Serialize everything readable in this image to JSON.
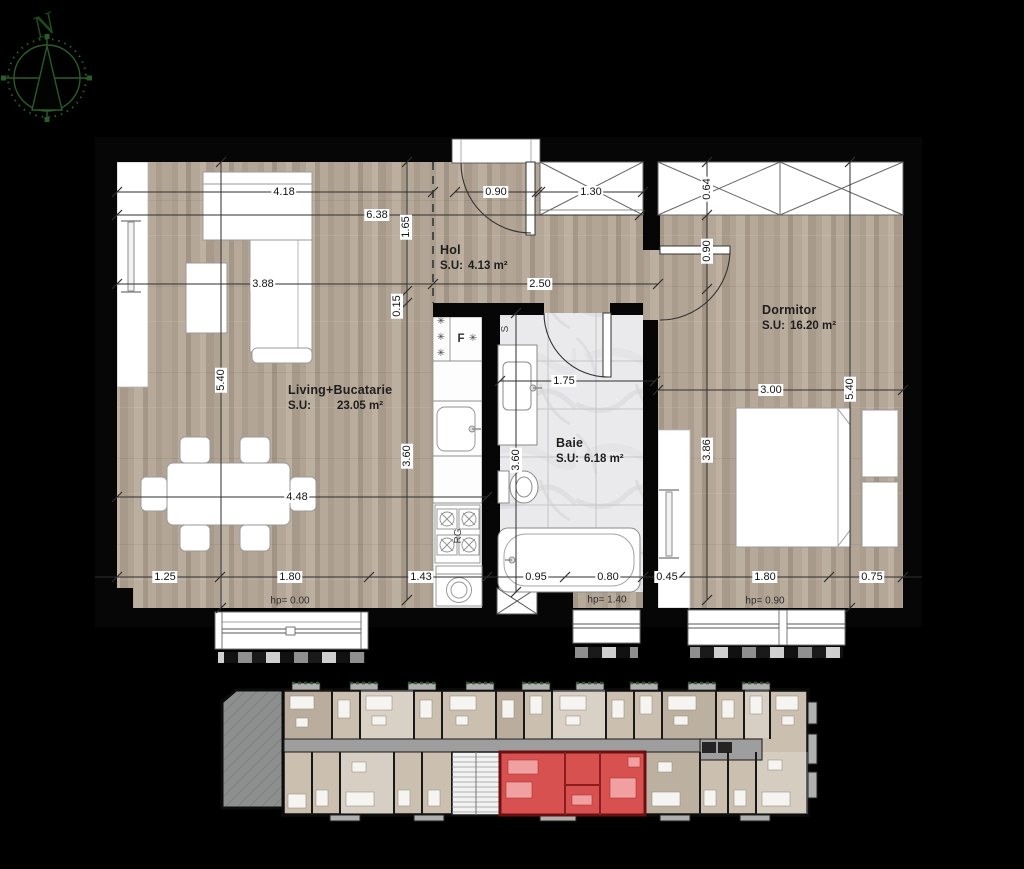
{
  "compass": {
    "north_label": "N"
  },
  "plan": {
    "rooms": [
      {
        "name": "Living+Bucatarie",
        "su": "S.U:",
        "area": "23.05 m²"
      },
      {
        "name": "Hol",
        "su": "S.U:",
        "area": "4.13 m²"
      },
      {
        "name": "Baie",
        "su": "S.U:",
        "area": "6.18 m²"
      },
      {
        "name": "Dormitor",
        "su": "S.U:",
        "area": "16.20 m²"
      }
    ],
    "dimensions": [
      {
        "t": "4.18",
        "x": 284,
        "y": 192
      },
      {
        "t": "0.90",
        "x": 496,
        "y": 192
      },
      {
        "t": "1.30",
        "x": 591,
        "y": 192
      },
      {
        "t": "6.38",
        "x": 377,
        "y": 215
      },
      {
        "t": "1.65",
        "x": 406,
        "y": 227,
        "r": 90
      },
      {
        "t": "0.64",
        "x": 707,
        "y": 189,
        "r": 90
      },
      {
        "t": "3.88",
        "x": 263,
        "y": 284
      },
      {
        "t": "2.50",
        "x": 540,
        "y": 284
      },
      {
        "t": "0.90",
        "x": 707,
        "y": 251,
        "r": 90
      },
      {
        "t": "0.15",
        "x": 397,
        "y": 306,
        "r": 90
      },
      {
        "t": "5.40",
        "x": 221,
        "y": 380,
        "r": 90
      },
      {
        "t": "1.75",
        "x": 564,
        "y": 381
      },
      {
        "t": "3.00",
        "x": 771,
        "y": 390
      },
      {
        "t": "5.40",
        "x": 850,
        "y": 389,
        "r": 90
      },
      {
        "t": "3.60",
        "x": 407,
        "y": 456,
        "r": 90
      },
      {
        "t": "3.60",
        "x": 516,
        "y": 460,
        "r": 90
      },
      {
        "t": "3.86",
        "x": 707,
        "y": 450,
        "r": 90
      },
      {
        "t": "4.48",
        "x": 297,
        "y": 497
      },
      {
        "t": "1.25",
        "x": 165,
        "y": 577
      },
      {
        "t": "1.80",
        "x": 290,
        "y": 577
      },
      {
        "t": "1.43",
        "x": 421,
        "y": 577
      },
      {
        "t": "0.95",
        "x": 536,
        "y": 577
      },
      {
        "t": "0.80",
        "x": 608,
        "y": 577
      },
      {
        "t": "0.45",
        "x": 667,
        "y": 577
      },
      {
        "t": "1.80",
        "x": 765,
        "y": 577
      },
      {
        "t": "0.75",
        "x": 872,
        "y": 577
      }
    ],
    "hp_labels": [
      {
        "t": "hp= 0.00",
        "x": 290,
        "y": 601
      },
      {
        "t": "hp= 1.40",
        "x": 607,
        "y": 600
      },
      {
        "t": "hp= 0.90",
        "x": 765,
        "y": 601
      }
    ],
    "fixture_labels": [
      {
        "t": "F",
        "x": 461,
        "y": 339,
        "n": "fridge-label",
        "b": 1
      },
      {
        "t": "✳",
        "x": 441,
        "y": 322,
        "n": "snowflake-icon"
      },
      {
        "t": "✳",
        "x": 441,
        "y": 338,
        "n": "snowflake-icon"
      },
      {
        "t": "✳",
        "x": 441,
        "y": 354,
        "n": "snowflake-icon"
      },
      {
        "t": "✳",
        "x": 473,
        "y": 339,
        "n": "snowflake-icon"
      },
      {
        "t": "S",
        "x": 506,
        "y": 329,
        "r": 90,
        "n": "sink-label"
      },
      {
        "t": "RG",
        "x": 459,
        "y": 536,
        "r": 90,
        "n": "stove-label"
      }
    ]
  },
  "overview": {
    "highlight_color": "#d85151"
  },
  "colors": {
    "wall": "#060606",
    "wood_floor": "#b2a494",
    "bath_floor": "#eaeaed",
    "dimension_text": "#141414",
    "compass_green": "#2a5c2a",
    "overview_floor": "#cbbfb0",
    "overview_corridor": "#9e9e9e",
    "overview_terrace": "#8d8e8e",
    "highlight_red": "#d85151",
    "highlight_wall": "#6b1010"
  }
}
